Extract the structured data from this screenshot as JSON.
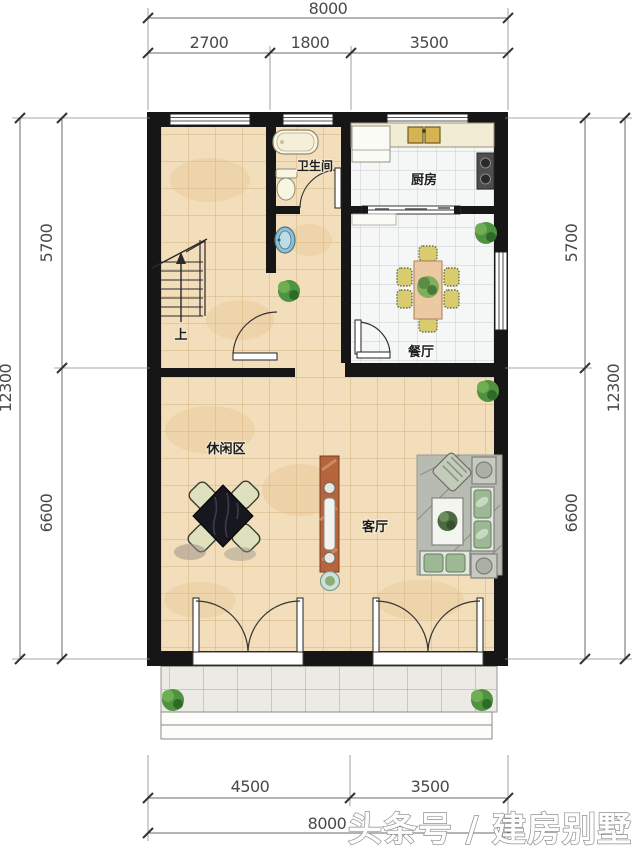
{
  "watermark": "头条号 / 建房别墅",
  "rooms": {
    "bathroom": "卫生间",
    "kitchen": "厨房",
    "dining": "餐厅",
    "leisure": "休闲区",
    "living": "客厅",
    "stairs_up": "上"
  },
  "dimensions": {
    "top": {
      "total": "8000",
      "segments": [
        "2700",
        "1800",
        "3500"
      ]
    },
    "left": {
      "total": "12300",
      "segments": [
        "5700",
        "6600"
      ]
    },
    "right": {
      "total": "12300",
      "segments": [
        "5700",
        "6600"
      ]
    },
    "bottom": {
      "total": "8000",
      "segments": [
        "4500",
        "3500"
      ]
    }
  },
  "colors": {
    "wall": "#161616",
    "floor_tan": "#f3debb",
    "floor_white_tile": "#f5f7f7",
    "porch": "#eceae5",
    "tv_cabinet": "#b5643c",
    "plant_green": "#3e7d32",
    "dim_text": "#4a4a4a"
  }
}
